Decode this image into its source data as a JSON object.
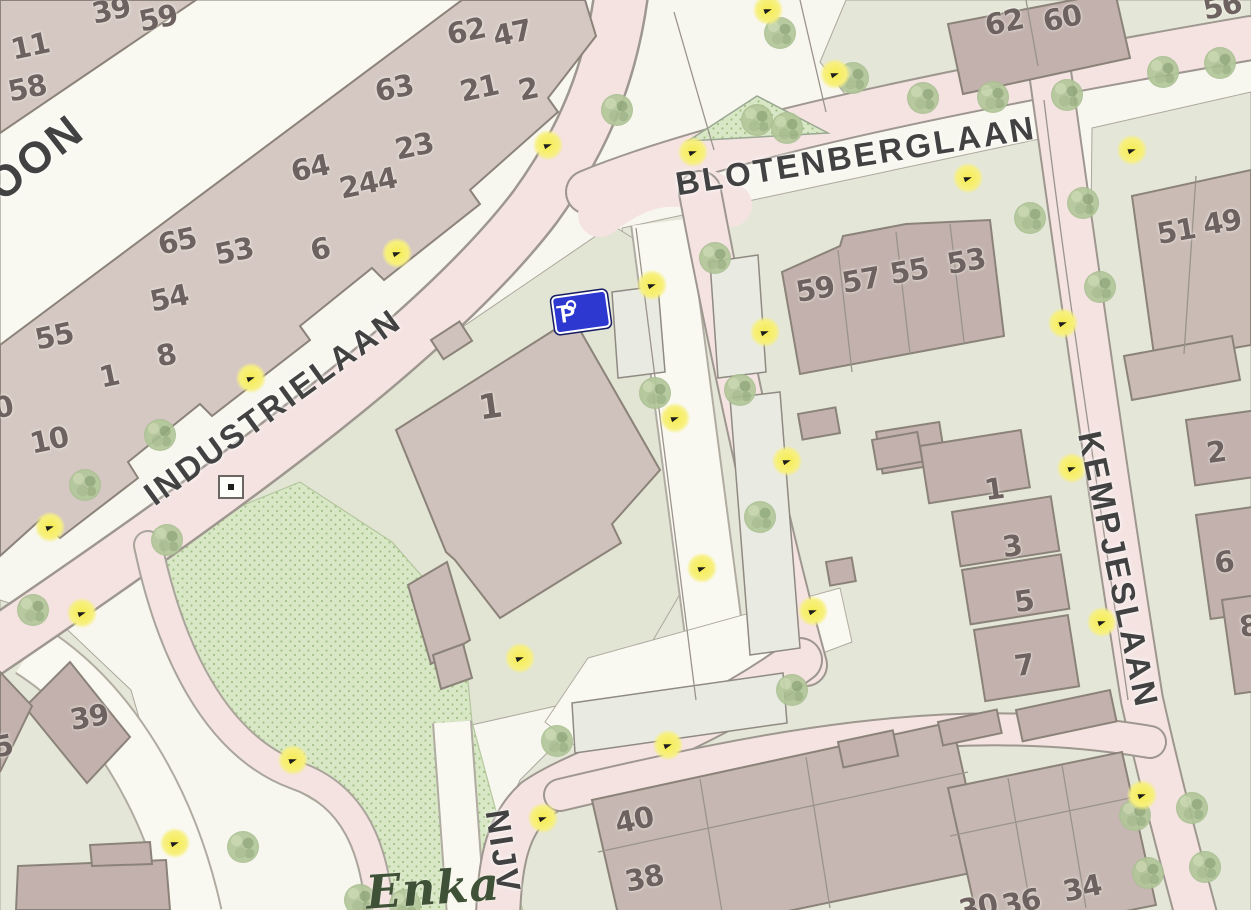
{
  "map": {
    "street_labels": [
      {
        "text": "OON",
        "x": 36,
        "y": 158,
        "r": -38,
        "s": 44
      },
      {
        "text": "INDUSTRIELAAN",
        "x": 273,
        "y": 407,
        "r": -36,
        "s": 33
      },
      {
        "text": "BLOTENBERGLAAN",
        "x": 856,
        "y": 156,
        "r": -9,
        "s": 33
      },
      {
        "text": "KEMPJESLAAN",
        "x": 1118,
        "y": 570,
        "r": 78,
        "s": 33
      },
      {
        "text": "NIJV",
        "x": 503,
        "y": 852,
        "r": 81,
        "s": 33
      }
    ],
    "place_labels": [
      {
        "text": "Enka",
        "x": 433,
        "y": 888,
        "r": -4,
        "s": 46
      }
    ],
    "house_numbers": [
      {
        "text": "11",
        "x": 30,
        "y": 46,
        "r": -12
      },
      {
        "text": "58",
        "x": 27,
        "y": 88,
        "r": -12
      },
      {
        "text": "39",
        "x": 111,
        "y": 10,
        "r": -12
      },
      {
        "text": "59",
        "x": 158,
        "y": 18,
        "r": -12
      },
      {
        "text": "62",
        "x": 466,
        "y": 31,
        "r": -12
      },
      {
        "text": "47",
        "x": 512,
        "y": 33,
        "r": -12
      },
      {
        "text": "63",
        "x": 394,
        "y": 88,
        "r": -12
      },
      {
        "text": "21",
        "x": 479,
        "y": 88,
        "r": -12
      },
      {
        "text": "2",
        "x": 528,
        "y": 89,
        "r": -12
      },
      {
        "text": "23",
        "x": 414,
        "y": 146,
        "r": -12
      },
      {
        "text": "64",
        "x": 310,
        "y": 168,
        "r": -12
      },
      {
        "text": "244",
        "x": 368,
        "y": 183,
        "r": -12
      },
      {
        "text": "65",
        "x": 177,
        "y": 241,
        "r": -12
      },
      {
        "text": "53",
        "x": 234,
        "y": 251,
        "r": -12
      },
      {
        "text": "6",
        "x": 320,
        "y": 249,
        "r": -12
      },
      {
        "text": "54",
        "x": 169,
        "y": 298,
        "r": -12
      },
      {
        "text": "55",
        "x": 54,
        "y": 336,
        "r": -12
      },
      {
        "text": "8",
        "x": 166,
        "y": 355,
        "r": -12
      },
      {
        "text": "1",
        "x": 109,
        "y": 376,
        "r": -12
      },
      {
        "text": "0",
        "x": 3,
        "y": 407,
        "r": -12
      },
      {
        "text": "10",
        "x": 49,
        "y": 440,
        "r": -12
      },
      {
        "text": "1",
        "x": 490,
        "y": 407,
        "r": -8,
        "s": 34
      },
      {
        "text": "39",
        "x": 89,
        "y": 717,
        "r": -10
      },
      {
        "text": "5",
        "x": 3,
        "y": 746,
        "r": -10
      },
      {
        "text": "59",
        "x": 815,
        "y": 289,
        "r": -10
      },
      {
        "text": "57",
        "x": 861,
        "y": 280,
        "r": -10
      },
      {
        "text": "55",
        "x": 909,
        "y": 271,
        "r": -10
      },
      {
        "text": "53",
        "x": 966,
        "y": 261,
        "r": -10
      },
      {
        "text": "62",
        "x": 1004,
        "y": 22,
        "r": -12
      },
      {
        "text": "60",
        "x": 1062,
        "y": 18,
        "r": -12
      },
      {
        "text": "56",
        "x": 1222,
        "y": 6,
        "r": -12
      },
      {
        "text": "51",
        "x": 1176,
        "y": 231,
        "r": -10
      },
      {
        "text": "49",
        "x": 1222,
        "y": 222,
        "r": -10
      },
      {
        "text": "1",
        "x": 994,
        "y": 489,
        "r": -8
      },
      {
        "text": "3",
        "x": 1012,
        "y": 546,
        "r": -8
      },
      {
        "text": "5",
        "x": 1024,
        "y": 601,
        "r": -8
      },
      {
        "text": "7",
        "x": 1024,
        "y": 665,
        "r": -8
      },
      {
        "text": "2",
        "x": 1216,
        "y": 452,
        "r": -8
      },
      {
        "text": "6",
        "x": 1224,
        "y": 562,
        "r": -8
      },
      {
        "text": "8",
        "x": 1249,
        "y": 626,
        "r": -8
      },
      {
        "text": "40",
        "x": 634,
        "y": 820,
        "r": -12
      },
      {
        "text": "38",
        "x": 644,
        "y": 878,
        "r": -12
      },
      {
        "text": "34",
        "x": 1082,
        "y": 888,
        "r": -12
      },
      {
        "text": "36",
        "x": 1021,
        "y": 902,
        "r": -12
      },
      {
        "text": "30",
        "x": 978,
        "y": 907,
        "r": -12
      }
    ],
    "poi": {
      "parking_sign": {
        "label": "P",
        "color": "#2c38cf"
      }
    },
    "streetlights": [
      {
        "x": 768,
        "y": 10
      },
      {
        "x": 835,
        "y": 74
      },
      {
        "x": 548,
        "y": 145
      },
      {
        "x": 693,
        "y": 152
      },
      {
        "x": 968,
        "y": 178
      },
      {
        "x": 1132,
        "y": 150
      },
      {
        "x": 397,
        "y": 253
      },
      {
        "x": 251,
        "y": 378
      },
      {
        "x": 50,
        "y": 527
      },
      {
        "x": 82,
        "y": 613
      },
      {
        "x": 652,
        "y": 285
      },
      {
        "x": 765,
        "y": 332
      },
      {
        "x": 675,
        "y": 418
      },
      {
        "x": 787,
        "y": 461
      },
      {
        "x": 702,
        "y": 568
      },
      {
        "x": 813,
        "y": 611
      },
      {
        "x": 520,
        "y": 658
      },
      {
        "x": 293,
        "y": 760
      },
      {
        "x": 175,
        "y": 843
      },
      {
        "x": 543,
        "y": 818
      },
      {
        "x": 668,
        "y": 745
      },
      {
        "x": 1142,
        "y": 795
      },
      {
        "x": 1072,
        "y": 468
      },
      {
        "x": 1102,
        "y": 622
      },
      {
        "x": 1063,
        "y": 323
      }
    ],
    "trees": [
      {
        "x": 617,
        "y": 110
      },
      {
        "x": 780,
        "y": 33
      },
      {
        "x": 853,
        "y": 78
      },
      {
        "x": 923,
        "y": 98
      },
      {
        "x": 993,
        "y": 97
      },
      {
        "x": 1067,
        "y": 95
      },
      {
        "x": 1163,
        "y": 72
      },
      {
        "x": 1220,
        "y": 63
      },
      {
        "x": 1030,
        "y": 218
      },
      {
        "x": 1083,
        "y": 203
      },
      {
        "x": 1100,
        "y": 287
      },
      {
        "x": 715,
        "y": 258
      },
      {
        "x": 655,
        "y": 393
      },
      {
        "x": 740,
        "y": 390
      },
      {
        "x": 760,
        "y": 517
      },
      {
        "x": 792,
        "y": 690
      },
      {
        "x": 557,
        "y": 741
      },
      {
        "x": 33,
        "y": 610
      },
      {
        "x": 167,
        "y": 540
      },
      {
        "x": 243,
        "y": 847
      },
      {
        "x": 160,
        "y": 435
      },
      {
        "x": 85,
        "y": 485
      },
      {
        "x": 1135,
        "y": 815
      },
      {
        "x": 1192,
        "y": 808
      },
      {
        "x": 1148,
        "y": 873
      },
      {
        "x": 1205,
        "y": 867
      },
      {
        "x": 757,
        "y": 120
      },
      {
        "x": 787,
        "y": 128
      },
      {
        "x": 360,
        "y": 900
      },
      {
        "x": 405,
        "y": 905
      }
    ],
    "colors": {
      "road_pink": "#f4e3e1",
      "road_white": "#faf9f1",
      "park_green": "#d8e7c5",
      "parcel_sage": "#e4e6d7",
      "building_light": "#d5c8c3",
      "building_dark": "#c2b1ad",
      "streetlight_yellow": "#f6ec52",
      "parking_sign_blue": "#2c38cf"
    }
  }
}
